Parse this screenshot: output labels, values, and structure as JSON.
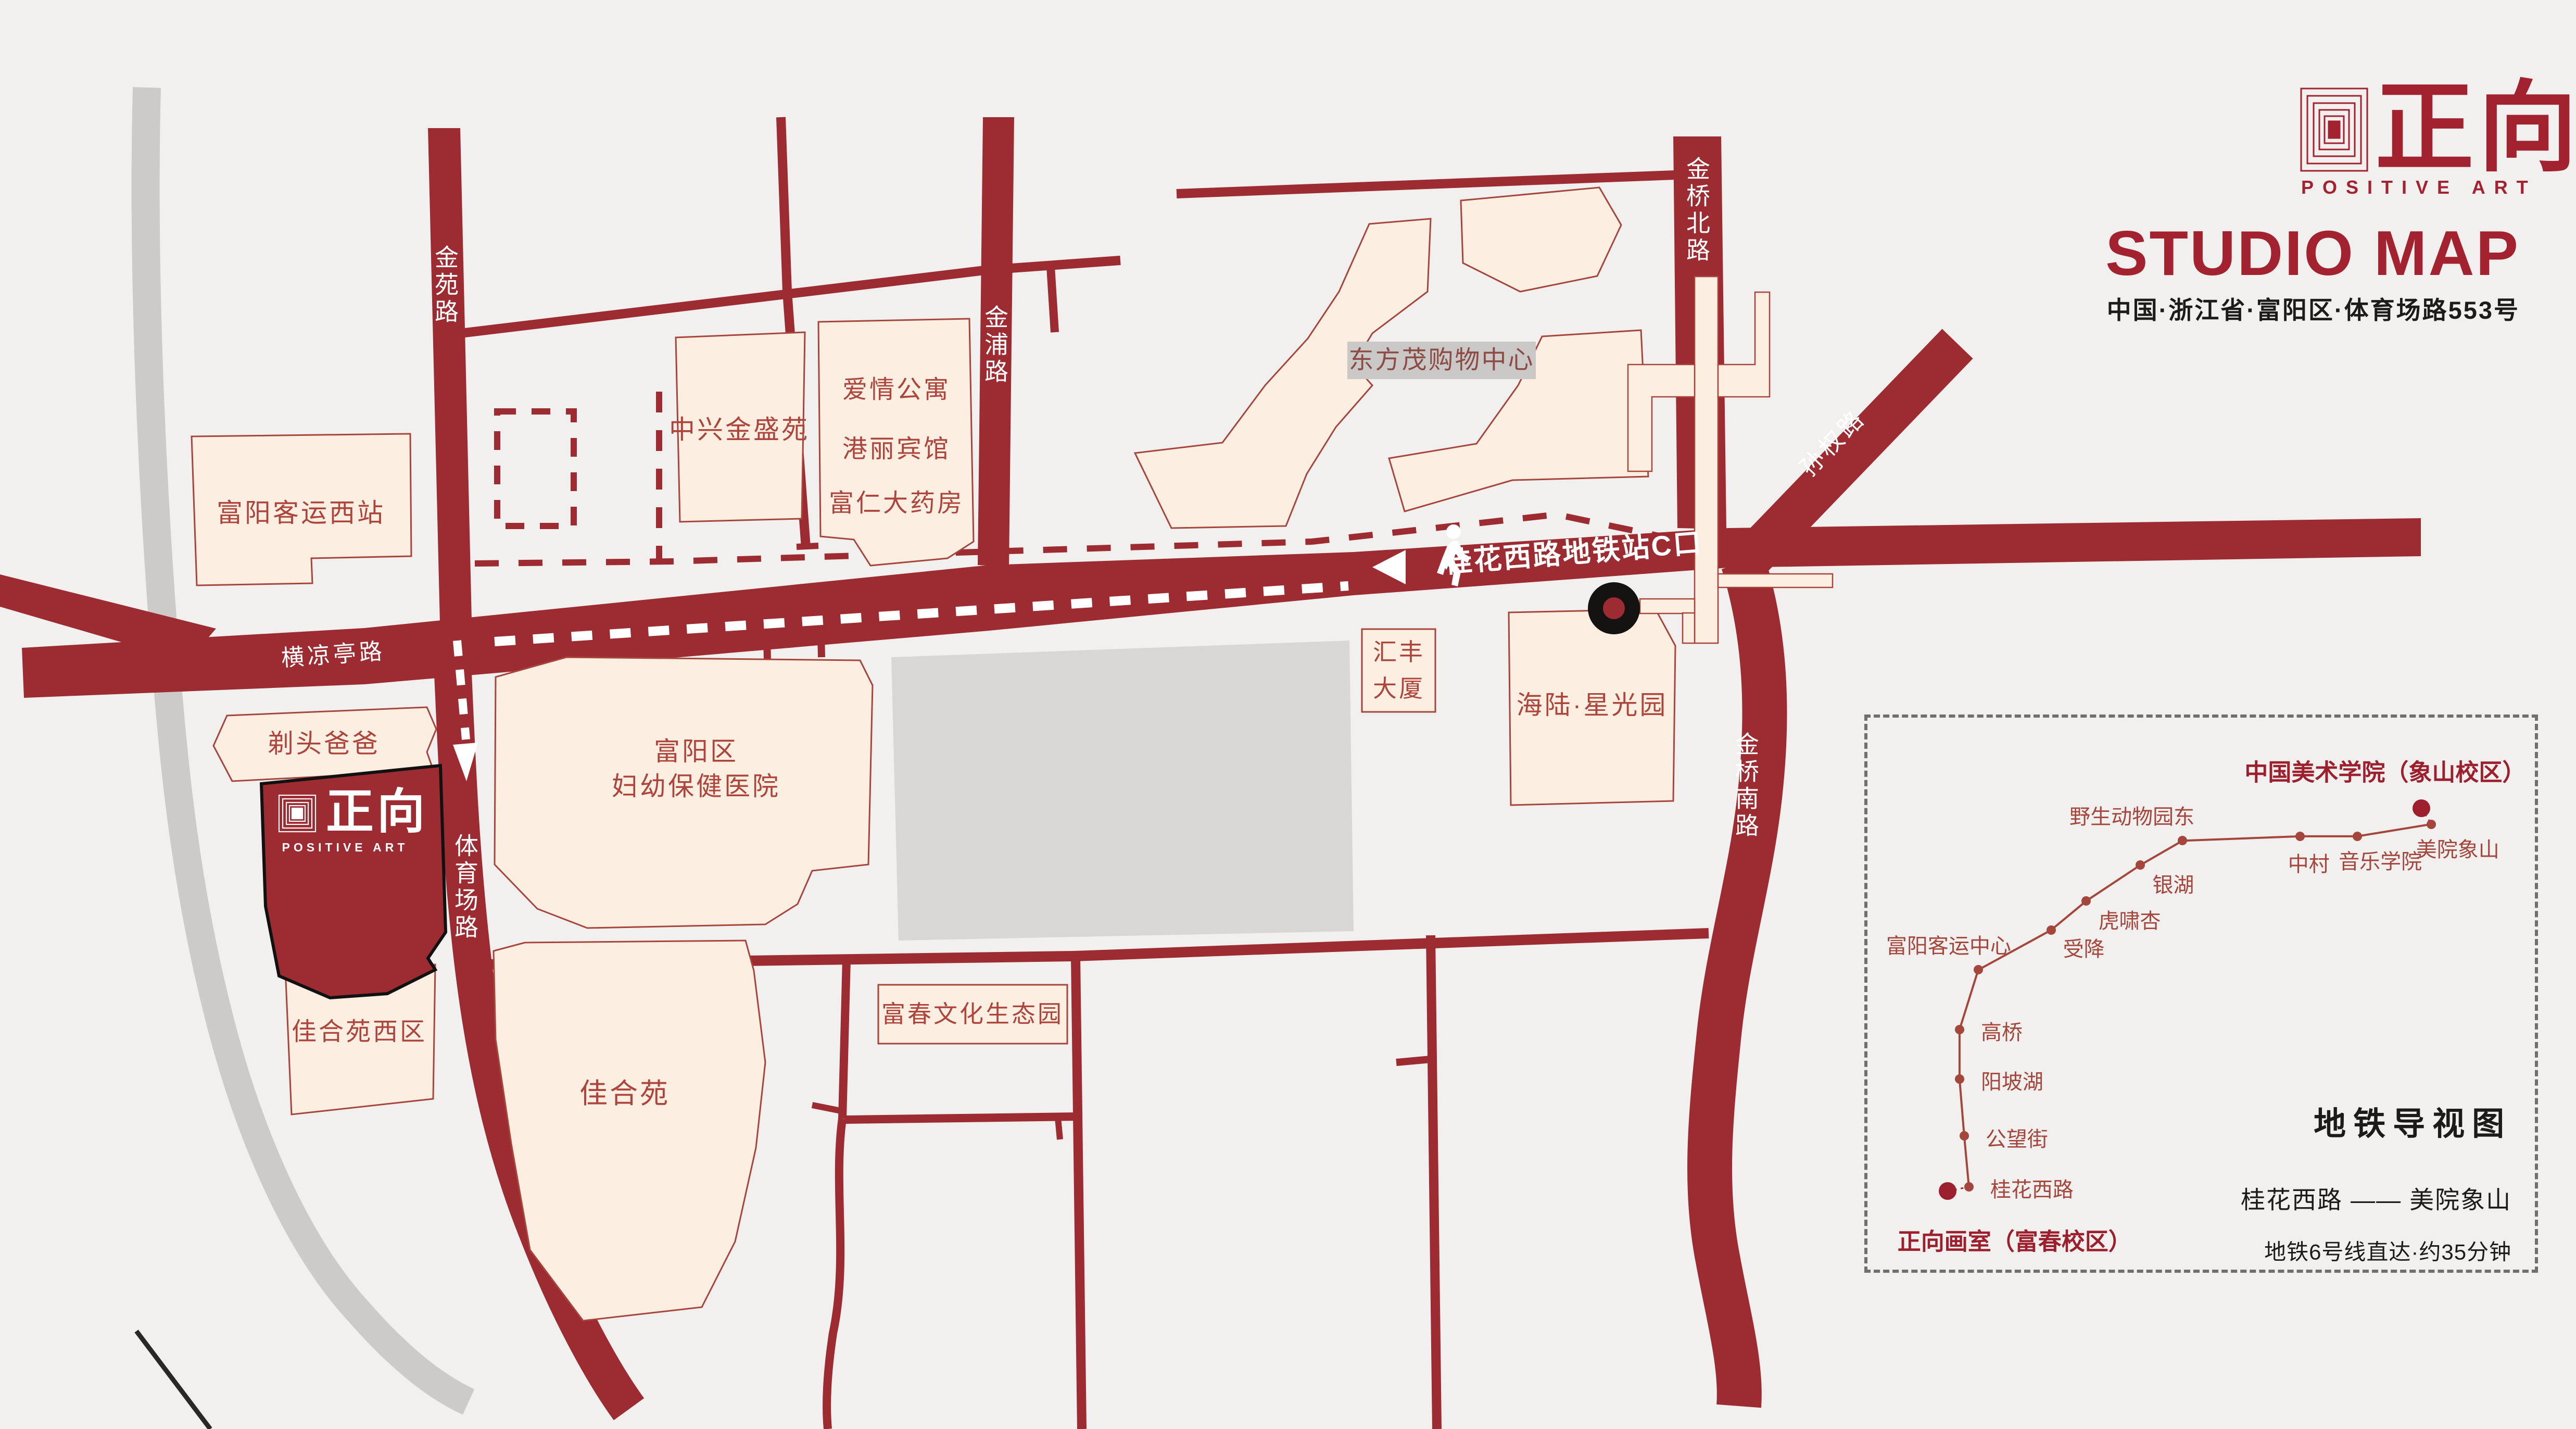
{
  "header": {
    "brand_cn": "正向",
    "brand_en": "POSITIVE ART",
    "title": "STUDIO MAP",
    "address": "中国·浙江省·富阳区·体育场路553号"
  },
  "colors": {
    "road": "#9c2b32",
    "brand_red": "#a32230",
    "building_fill": "#fcefe2",
    "building_stroke": "#a7453c",
    "building_text": "#ad453d",
    "gray_road": "#cccbc9",
    "marker_black": "#151312",
    "metro_line": "#a4463c",
    "terminal_dot": "#9c1f2d"
  },
  "map": {
    "road_labels": {
      "jinyuan": "金苑路",
      "jinpu": "金浦路",
      "jinqiao_north": "金桥北路",
      "sunquan": "孙权路",
      "hengliangting": "横凉亭路",
      "tiyuchang": "体育场路",
      "jinqiao_south": "金桥南路"
    },
    "route_label": "桂花西路地铁站C口",
    "buildings": {
      "fuyang_west_station": "富阳客运西站",
      "zhongxing": "中兴金盛苑",
      "apartment_lines": [
        "爱情公寓",
        "港丽宾馆",
        "富仁大药房"
      ],
      "dongfangmao": "东方茂购物中心",
      "huifeng_lines": [
        "汇丰",
        "大厦"
      ],
      "hailu": "海陆·星光园",
      "titou": "剃头爸爸",
      "hospital_lines": [
        "富阳区",
        "妇幼保健医院"
      ],
      "jiaheyuan_west": "佳合苑西区",
      "jiaheyuan": "佳合苑",
      "fuchun_park": "富春文化生态园"
    },
    "studio_marker": {
      "logo_cn": "正向",
      "logo_en": "POSITIVE ART"
    }
  },
  "metro_panel": {
    "title": "地铁导视图",
    "route": "桂花西路 —— 美院象山",
    "note": "地铁6号线直达·约35分钟",
    "terminals": [
      {
        "name": "正向画室（富春校区）",
        "x": 12.0,
        "y": 85.8,
        "lx": 4.5,
        "ly": 94.5,
        "align": "left"
      },
      {
        "name": "中国美术学院（象山校区）",
        "x": 83.0,
        "y": 16.4,
        "lx": 56.5,
        "ly": 9.5,
        "align": "left"
      }
    ],
    "stations": [
      {
        "name": "桂花西路",
        "x": 15.2,
        "y": 85.0,
        "lx": 18.4,
        "ly": 85.2,
        "align": "left"
      },
      {
        "name": "公望街",
        "x": 14.5,
        "y": 75.8,
        "lx": 17.7,
        "ly": 76.0,
        "align": "left"
      },
      {
        "name": "阳坡湖",
        "x": 13.8,
        "y": 65.5,
        "lx": 17.0,
        "ly": 65.7,
        "align": "left"
      },
      {
        "name": "高桥",
        "x": 13.8,
        "y": 56.5,
        "lx": 17.0,
        "ly": 56.7,
        "align": "left"
      },
      {
        "name": "富阳客运中心",
        "x": 16.6,
        "y": 45.7,
        "lx": 2.8,
        "ly": 41.0,
        "align": "left"
      },
      {
        "name": "受降",
        "x": 27.5,
        "y": 38.5,
        "lx": 29.3,
        "ly": 41.6,
        "align": "left"
      },
      {
        "name": "虎啸杏",
        "x": 32.8,
        "y": 33.2,
        "lx": 34.6,
        "ly": 36.5,
        "align": "left"
      },
      {
        "name": "银湖",
        "x": 40.9,
        "y": 26.7,
        "lx": 42.7,
        "ly": 30.0,
        "align": "left"
      },
      {
        "name": "野生动物园东",
        "x": 47.2,
        "y": 22.3,
        "lx": 49.0,
        "ly": 17.6,
        "align": "right"
      },
      {
        "name": "中村",
        "x": 64.8,
        "y": 21.5,
        "lx": 63.0,
        "ly": 26.2,
        "align": "left"
      },
      {
        "name": "音乐学院",
        "x": 73.4,
        "y": 21.5,
        "lx": 70.6,
        "ly": 25.8,
        "align": "left"
      },
      {
        "name": "美院象山",
        "x": 84.5,
        "y": 19.3,
        "lx": 82.2,
        "ly": 23.6,
        "align": "left"
      }
    ]
  }
}
